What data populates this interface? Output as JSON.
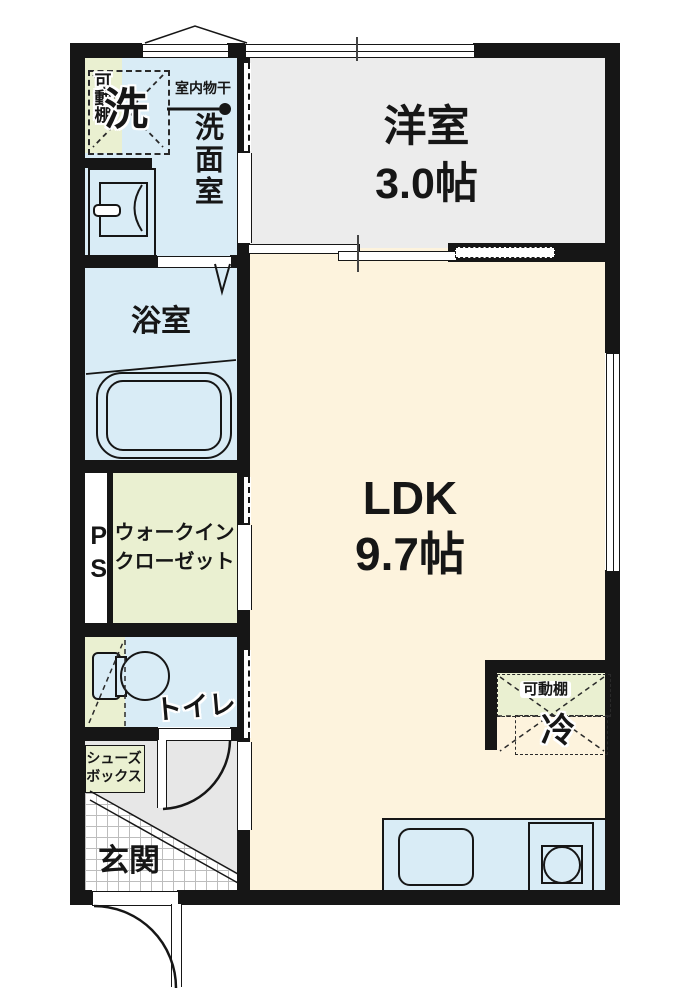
{
  "floorplan": {
    "type": "japanese-apartment-floor-plan",
    "rooms": {
      "western_room": {
        "name": "洋室",
        "size": "3.0帖"
      },
      "ldk": {
        "name": "LDK",
        "size": "9.7帖"
      },
      "washroom": {
        "name": "洗面室"
      },
      "bathroom": {
        "name": "浴室"
      },
      "toilet": {
        "name": "トイレ"
      },
      "entrance": {
        "name": "玄関"
      },
      "walk_in_closet": {
        "line1": "ウォークイン",
        "line2": "クローゼット"
      },
      "pipe_space": {
        "name": "PS"
      }
    },
    "fixtures": {
      "washing_machine": {
        "label": "洗"
      },
      "movable_shelf_washroom": {
        "label": "可動棚"
      },
      "indoor_drying_pole": {
        "label": "室内物干"
      },
      "movable_shelf_kitchen": {
        "label": "可動棚"
      },
      "refrigerator": {
        "label": "冷"
      },
      "shoe_box": {
        "line1": "シューズ",
        "line2": "ボックス"
      }
    },
    "colors": {
      "wall": "#161616",
      "ldk_floor": "#fdf3dd",
      "western_room_floor": "#ececec",
      "wet_area_floor": "#d9ecf6",
      "shelf_green": "#eaf0d1",
      "hall_gray": "#e7e7e7"
    }
  }
}
